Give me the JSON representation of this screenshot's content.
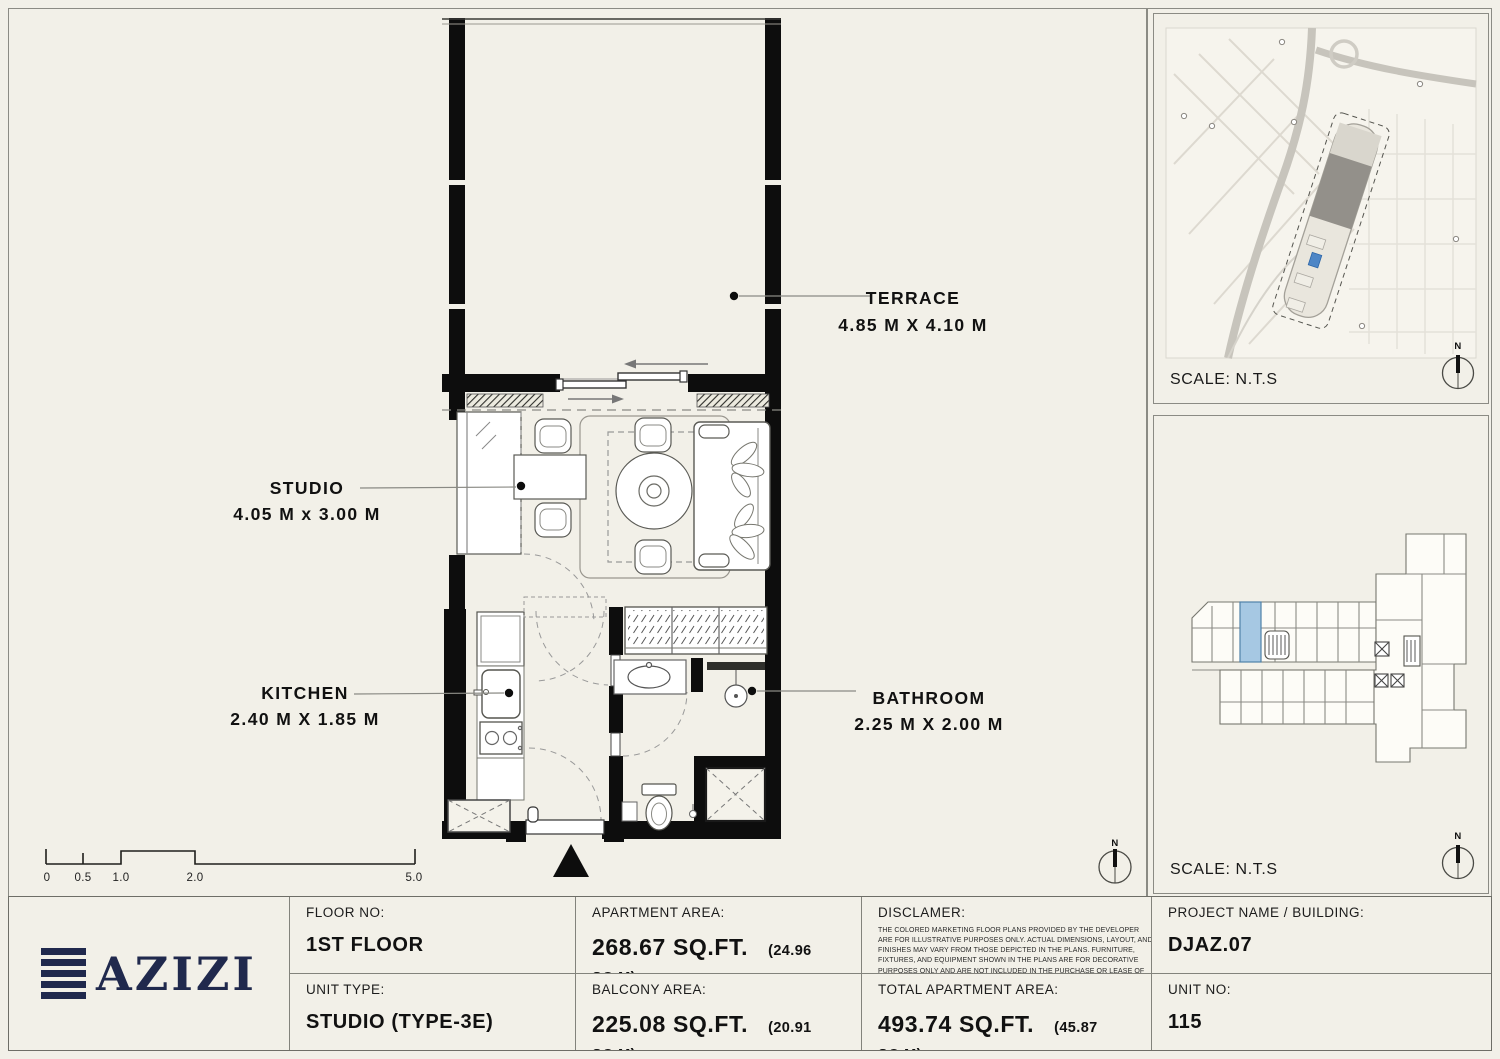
{
  "colors": {
    "paper": "#f2f0e8",
    "wall_black": "#0d0d0d",
    "logo_navy": "#20294d",
    "unit_highlight_blue": "#a6c8e3",
    "map_marker_blue": "#4e86c6"
  },
  "plan": {
    "north_label": "N",
    "rooms": [
      {
        "name": "TERRACE",
        "dims": "4.85 M X 4.10 M"
      },
      {
        "name": "STUDIO",
        "dims": "4.05 M x 3.00 M"
      },
      {
        "name": "KITCHEN",
        "dims": "2.40 M X 1.85 M"
      },
      {
        "name": "BATHROOM",
        "dims": "2.25 M X 2.00 M"
      }
    ],
    "scale_bar": {
      "labels": [
        "0",
        "0.5",
        "1.0",
        "2.0",
        "5.0"
      ]
    }
  },
  "map_panel": {
    "scale_label": "SCALE: N.T.S",
    "north_label": "N"
  },
  "keyplan_panel": {
    "scale_label": "SCALE: N.T.S",
    "north_label": "N"
  },
  "logo": {
    "name": "AZIZI"
  },
  "table": {
    "floor_label": "FLOOR NO:",
    "floor_value": "1ST FLOOR",
    "unit_type_label": "UNIT TYPE:",
    "unit_type_value": "STUDIO (TYPE-3E)",
    "apartment_area_label": "APARTMENT AREA:",
    "apartment_area_value": "268.67 SQ.FT.",
    "apartment_area_metric": "(24.96 SQ.M)",
    "balcony_area_label": "BALCONY AREA:",
    "balcony_area_value": "225.08 SQ.FT.",
    "balcony_area_metric": "(20.91 SQ.M)",
    "disclaimer_label": "DISCLAMER:",
    "disclaimer_text": "THE COLORED MARKETING FLOOR PLANS PROVIDED BY THE DEVELOPER ARE FOR ILLUSTRATIVE PURPOSES ONLY. ACTUAL DIMENSIONS, LAYOUT, AND FINISHES MAY VARY FROM THOSE DEPICTED IN THE PLANS. FURNITURE, FIXTURES, AND EQUIPMENT SHOWN IN THE PLANS ARE FOR DECORATIVE PURPOSES ONLY AND ARE NOT INCLUDED IN THE PURCHASE OR LEASE OF THE PROPERTY. THE DEVELOPER RESERVES THE RIGHT TO MAKE MODIFICATIONS, REVISIONS, AND CHANGES TO THE FLOOR PLANS, SPECIFICATIONS, AND FEATURES WITHOUT PRIOR NOTICE.",
    "total_area_label": "TOTAL APARTMENT AREA:",
    "total_area_value": "493.74 SQ.FT.",
    "total_area_metric": "(45.87 SQ.M)",
    "project_label": "PROJECT NAME / BUILDING:",
    "project_value": "DJAZ.07",
    "unit_no_label": "UNIT NO:",
    "unit_no_value": "115"
  }
}
